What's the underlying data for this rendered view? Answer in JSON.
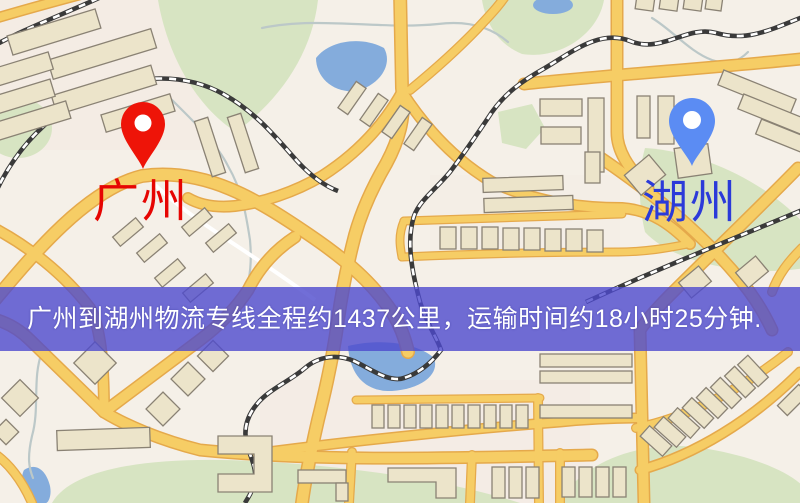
{
  "map": {
    "description_labels": [],
    "markers": [
      {
        "id": "guangzhou",
        "label": "广州",
        "pin_color": "#ee1408",
        "label_color": "#e60502",
        "side": "left"
      },
      {
        "id": "huzhou",
        "label": "湖州",
        "pin_color": "#5b8cf3",
        "label_color": "#2b3ad9",
        "side": "right"
      }
    ],
    "palette": {
      "background": "#f5f0e8",
      "road_fill": "#f6cd65",
      "road_casing": "#e5a94b",
      "park_green": "#d7e4c2",
      "water_blue": "#84acdc",
      "building_fill": "#ece4ca",
      "building_stroke": "#8a8274",
      "railway_dark": "#3a3a3a",
      "railway_light": "#ffffff"
    }
  },
  "banner": {
    "text": "广州到湖州物流专线全程约1437公里，运输时间约18小时25分钟.",
    "background": "rgba(77,74,205,0.80)",
    "text_color": "#ffffff"
  }
}
